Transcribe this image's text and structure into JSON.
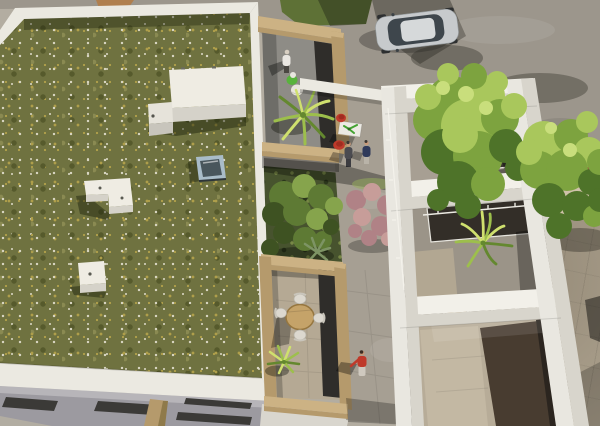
{
  "scene": {
    "type": "architectural-aerial-3d-render",
    "description": "Aerial 3D rendering of a residential complex: an extensive sedum green roof with rooftop equipment and a skylight hatch on the left, roof terraces with tan parapets, a sunken courtyard garden, a white concrete-frame building with three open courtyards on the right, and a street with a parked silver SUV and two trees at the top",
    "lighting": "sunny daytime, shadows cast toward lower-left"
  },
  "palette": {
    "base_ground": "#b3ada1",
    "street_grey": "#9c968c",
    "grass_patch": "#5e7136",
    "roof_green_base": "#6f7240",
    "roof_green_dark": "#565a2c",
    "roof_green_olive": "#8a8a52",
    "flower_white": "#dad7c4",
    "flower_yellow": "#af9f4b",
    "parapet_white": "#ebe9e1",
    "facade_grey": "#9c9aa0",
    "facade_light": "#b7b5b9",
    "window_dark": "#3b3a37",
    "tan_wall": "#b59a6c",
    "tan_wall_light": "#ccb284",
    "tan_wall_dark": "#8f7a4a",
    "terrace_floor": "#8e8c86",
    "dark_glass": "#2f2d2a",
    "struct_top": "#efece3",
    "struct_side": "#d5d2c9",
    "frame_top": "#f2f0e9",
    "frame_front": "#d8d5cc",
    "frame_white": "#e9e7e0",
    "plaza_concrete": "#a69f93",
    "stone_pave": "#b4a995",
    "stone_beige": "#b5a994",
    "lawn_green": "#47532e",
    "bush_green": "#5e7a34",
    "bush_light": "#86a44c",
    "bush_dark": "#3e5222",
    "pink_shrub": "#b08286",
    "pink_light": "#c79d99",
    "palm_bright": "#cfe06e",
    "palm_mid": "#9dbf4c",
    "palm_dark": "#64882f",
    "tree_light": "#a9c75c",
    "tree_mid": "#7da33f",
    "tree_dark": "#4e7329",
    "tree_glint": "#c9de7c",
    "car_body": "#c7cacc",
    "car_glass": "#3e464c",
    "car_roof": "#d6d9da",
    "red_accent": "#bf3a2b",
    "navy": "#2f3a5a",
    "white_cloth": "#e9e6e1",
    "skin": "#c89a79",
    "wood": "#c5a369",
    "chair_white": "#dcd8cf",
    "paving_red": "#9c5a41",
    "sidewalk": "#cfc2aa",
    "hvac": "#b6bbbe",
    "skylight_frame": "#a9bcc8",
    "skylight_glass": "#49565c"
  },
  "elements": {
    "green_roof": {
      "label": "extensive green roof covered in sedum with white and yellow wildflowers"
    },
    "roof_parapet": {
      "label": "white parapet wall around the green roof"
    },
    "roof_equipment": {
      "label": "three white rooftop equipment boxes (one large L-shaped, one small L-shaped, one small box)"
    },
    "skylight": {
      "label": "roof access hatch / skylight with pale blue frame and dark glass"
    },
    "facade": {
      "label": "lower facade with horizontal slit windows and tan pillar"
    },
    "street": {
      "label": "asphalt street with tree shadows, red clay paving strip and beige sidewalk"
    },
    "car": {
      "label": "silver SUV parked on the street"
    },
    "trees": {
      "label": "two broadleaf street trees",
      "count": 2
    },
    "top_terrace": {
      "label": "roof terrace with tan parapet, standing person, green and white bean bags and a potted palm"
    },
    "dining_terrace": {
      "label": "terrace with white square table, green table plant, two red chairs and two standing people"
    },
    "courtyard_garden": {
      "label": "sunken courtyard garden with green shrubs, pink flowering bush and agave"
    },
    "lower_terrace": {
      "label": "terrace with round wooden table, four white chairs and a potted yucca"
    },
    "walkway": {
      "label": "paved walkway with a person in a red shirt walking"
    },
    "white_building": {
      "label": "white concrete-frame building with three open courtyards, glass railings, HVAC units and an interior palm"
    }
  },
  "people": [
    {
      "location": "top terrace",
      "clothing": "white shirt, dark trousers",
      "pose": "standing"
    },
    {
      "location": "dining terrace",
      "clothing": "dark grey outfit",
      "pose": "standing"
    },
    {
      "location": "dining terrace",
      "clothing": "navy outfit",
      "pose": "standing"
    },
    {
      "location": "walkway",
      "clothing": "red shirt, light trousers",
      "pose": "walking"
    }
  ],
  "furniture": {
    "dining_terrace": "white square table with green plant, two red lounge chairs",
    "lower_terrace": "round wooden table with four white chairs",
    "top_terrace": "green bean bag, white bean bag, potted palm"
  },
  "vehicles": [
    {
      "type": "SUV",
      "color": "silver"
    }
  ]
}
